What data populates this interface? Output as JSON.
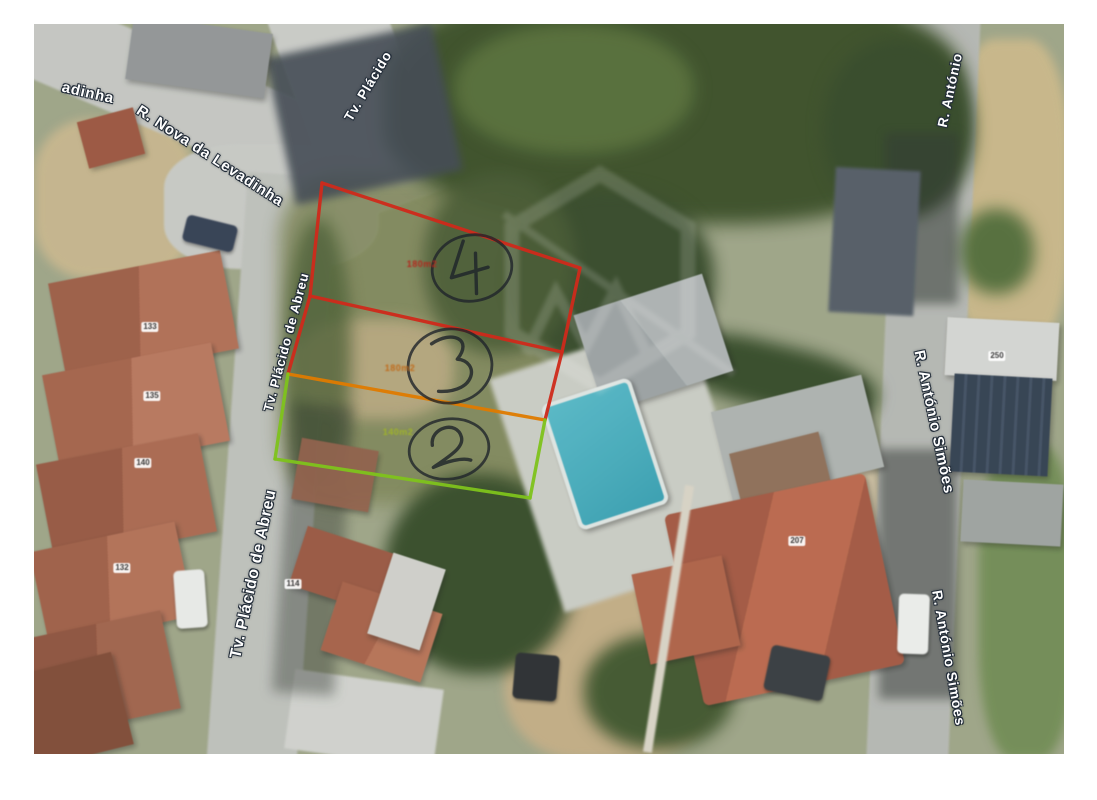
{
  "document": {
    "type": "scanned aerial photograph with annotated land lots",
    "background_color": "#ffffff"
  },
  "streets": {
    "labels": [
      {
        "name": "r-nova-da-levadinha-partial",
        "text": "adinha",
        "x": 54,
        "y": 69,
        "rotate": 13,
        "size": 15
      },
      {
        "name": "r-nova-da-levadinha",
        "text": "R. Nova da Levadinha",
        "x": 176,
        "y": 132,
        "rotate": 33,
        "size": 15
      },
      {
        "name": "tv-placido-top",
        "text": "Tv. Plácido",
        "x": 334,
        "y": 62,
        "rotate": -59,
        "size": 13.5
      },
      {
        "name": "tv-placido-de-abreu-mid",
        "text": "Tv. Plácido de Abreu",
        "x": 252,
        "y": 318,
        "rotate": -75,
        "size": 13
      },
      {
        "name": "tv-placido-de-abreu-bottom",
        "text": "Tv. Plácido de Abreu",
        "x": 220,
        "y": 550,
        "rotate": -78,
        "size": 16
      },
      {
        "name": "r-antonio-top",
        "text": "R. António",
        "x": 916,
        "y": 66,
        "rotate": -78,
        "size": 13.5
      },
      {
        "name": "r-antonio-simoes-mid",
        "text": "R. António Simões",
        "x": 900,
        "y": 398,
        "rotate": 78,
        "size": 15
      },
      {
        "name": "r-antonio-simoes-bottom",
        "text": "R. António Simões",
        "x": 915,
        "y": 634,
        "rotate": 80,
        "size": 14
      }
    ]
  },
  "house_numbers": [
    {
      "text": "133",
      "x": 116,
      "y": 303
    },
    {
      "text": "135",
      "x": 118,
      "y": 372
    },
    {
      "text": "140",
      "x": 109,
      "y": 439
    },
    {
      "text": "132",
      "x": 88,
      "y": 544
    },
    {
      "text": "114",
      "x": 259,
      "y": 560
    },
    {
      "text": "250",
      "x": 963,
      "y": 332
    },
    {
      "text": "207",
      "x": 763,
      "y": 517
    }
  ],
  "lots": {
    "colors": {
      "red": "#cf2a1b",
      "orange": "#e07b00",
      "green": "#7fc31c"
    },
    "segments": [
      {
        "x1": 288,
        "y1": 159,
        "x2": 546,
        "y2": 244,
        "color": "red"
      },
      {
        "x1": 546,
        "y1": 244,
        "x2": 528,
        "y2": 328,
        "color": "red"
      },
      {
        "x1": 288,
        "y1": 159,
        "x2": 276,
        "y2": 272,
        "color": "red"
      },
      {
        "x1": 276,
        "y1": 272,
        "x2": 528,
        "y2": 328,
        "color": "red"
      },
      {
        "x1": 276,
        "y1": 272,
        "x2": 254,
        "y2": 350,
        "color": "red"
      },
      {
        "x1": 528,
        "y1": 328,
        "x2": 511,
        "y2": 396,
        "color": "red"
      },
      {
        "x1": 254,
        "y1": 350,
        "x2": 511,
        "y2": 396,
        "color": "orange"
      },
      {
        "x1": 254,
        "y1": 350,
        "x2": 241,
        "y2": 435,
        "color": "green"
      },
      {
        "x1": 511,
        "y1": 396,
        "x2": 496,
        "y2": 474,
        "color": "green"
      },
      {
        "x1": 241,
        "y1": 435,
        "x2": 496,
        "y2": 474,
        "color": "green"
      }
    ],
    "markers": [
      {
        "digit": "4",
        "x": 438,
        "y": 244,
        "rx": 40,
        "ry": 33,
        "rotate": -10,
        "area_text": "180m2",
        "area_x": 388,
        "area_y": 240,
        "area_color": "#b3271c"
      },
      {
        "digit": "3",
        "x": 416,
        "y": 342,
        "rx": 42,
        "ry": 37,
        "rotate": -6,
        "area_text": "180m2",
        "area_x": 366,
        "area_y": 344,
        "area_color": "#c06a1a"
      },
      {
        "digit": "2",
        "x": 415,
        "y": 425,
        "rx": 40,
        "ry": 30,
        "rotate": -8,
        "area_text": "140m2",
        "area_x": 364,
        "area_y": 408,
        "area_color": "#9fb32a"
      }
    ]
  }
}
